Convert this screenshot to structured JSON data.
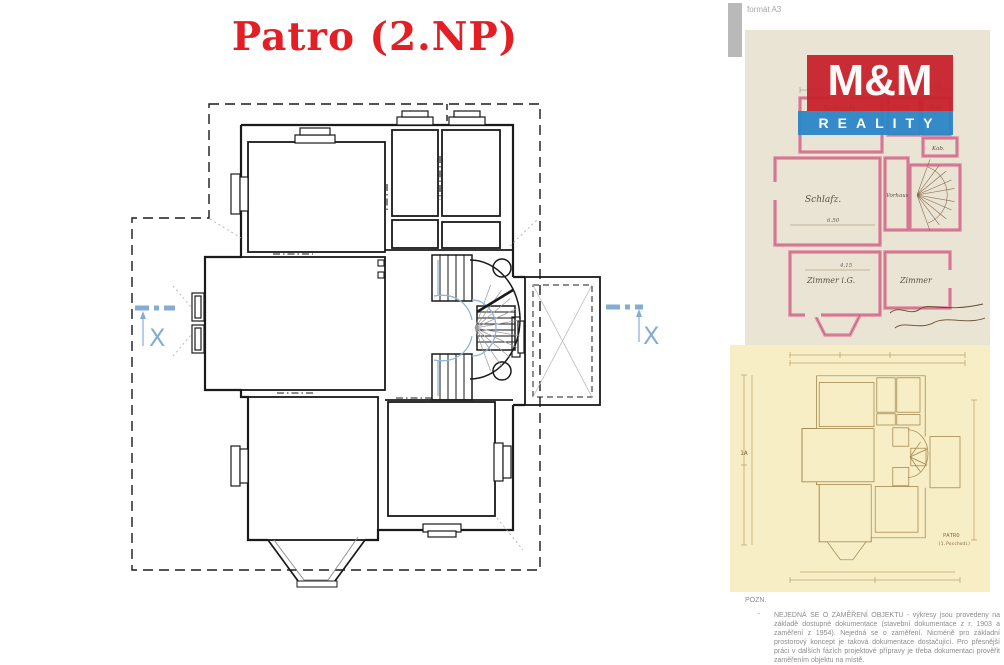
{
  "title": {
    "text": "Patro (2.NP)"
  },
  "main_plan": {
    "section_marker": "X"
  },
  "side_panel": {
    "format_label": "formát A3",
    "logo": {
      "line1": "M&M",
      "line2": "REALITY"
    },
    "pink_plan": {
      "rooms": {
        "r1": "Schlafz.",
        "r2": "Gard.",
        "r3": "Bad",
        "r4": "Kab.",
        "r5": "Schlafz.",
        "r6": "Vorhaus",
        "r7": "Zimmer i.G.",
        "r8": "Zimmer"
      },
      "dims": {
        "d1": "5.90",
        "d2": "2.10",
        "d3": "1.70",
        "d4": "6.50",
        "d5": "4.15"
      }
    },
    "yellow_plan": {
      "ref": "1A",
      "caption": "PATRO",
      "caption_sub": "(1.Poschodí)"
    },
    "note": {
      "heading": "POZN.",
      "bullet": "-",
      "body": "NEJEDNÁ SE O ZAMĚŘENÍ OBJEKTU - výkresy jsou provedeny na základě dostupné dokumentace (stavební dokumentace z r. 1903 a zaměření z 1954). Nejedná se o zaměření. Nicméně pro základní prostorový koncept je taková dokumentace dostačující. Pro přesnější práci v dalších fázích projektové přípravy je třeba dokumentaci prověřit zaměřením objektu na místě."
    }
  },
  "colors": {
    "title_red": "#e31e24",
    "logo_red": "#c8232c",
    "logo_blue": "#2b87c8",
    "marker_blue": "#85add4",
    "pink_wall": "#e58fa8",
    "pink_paper": "#e9e4d3",
    "yellow_paper": "#f8eec6",
    "yellow_line": "#9d8045"
  }
}
